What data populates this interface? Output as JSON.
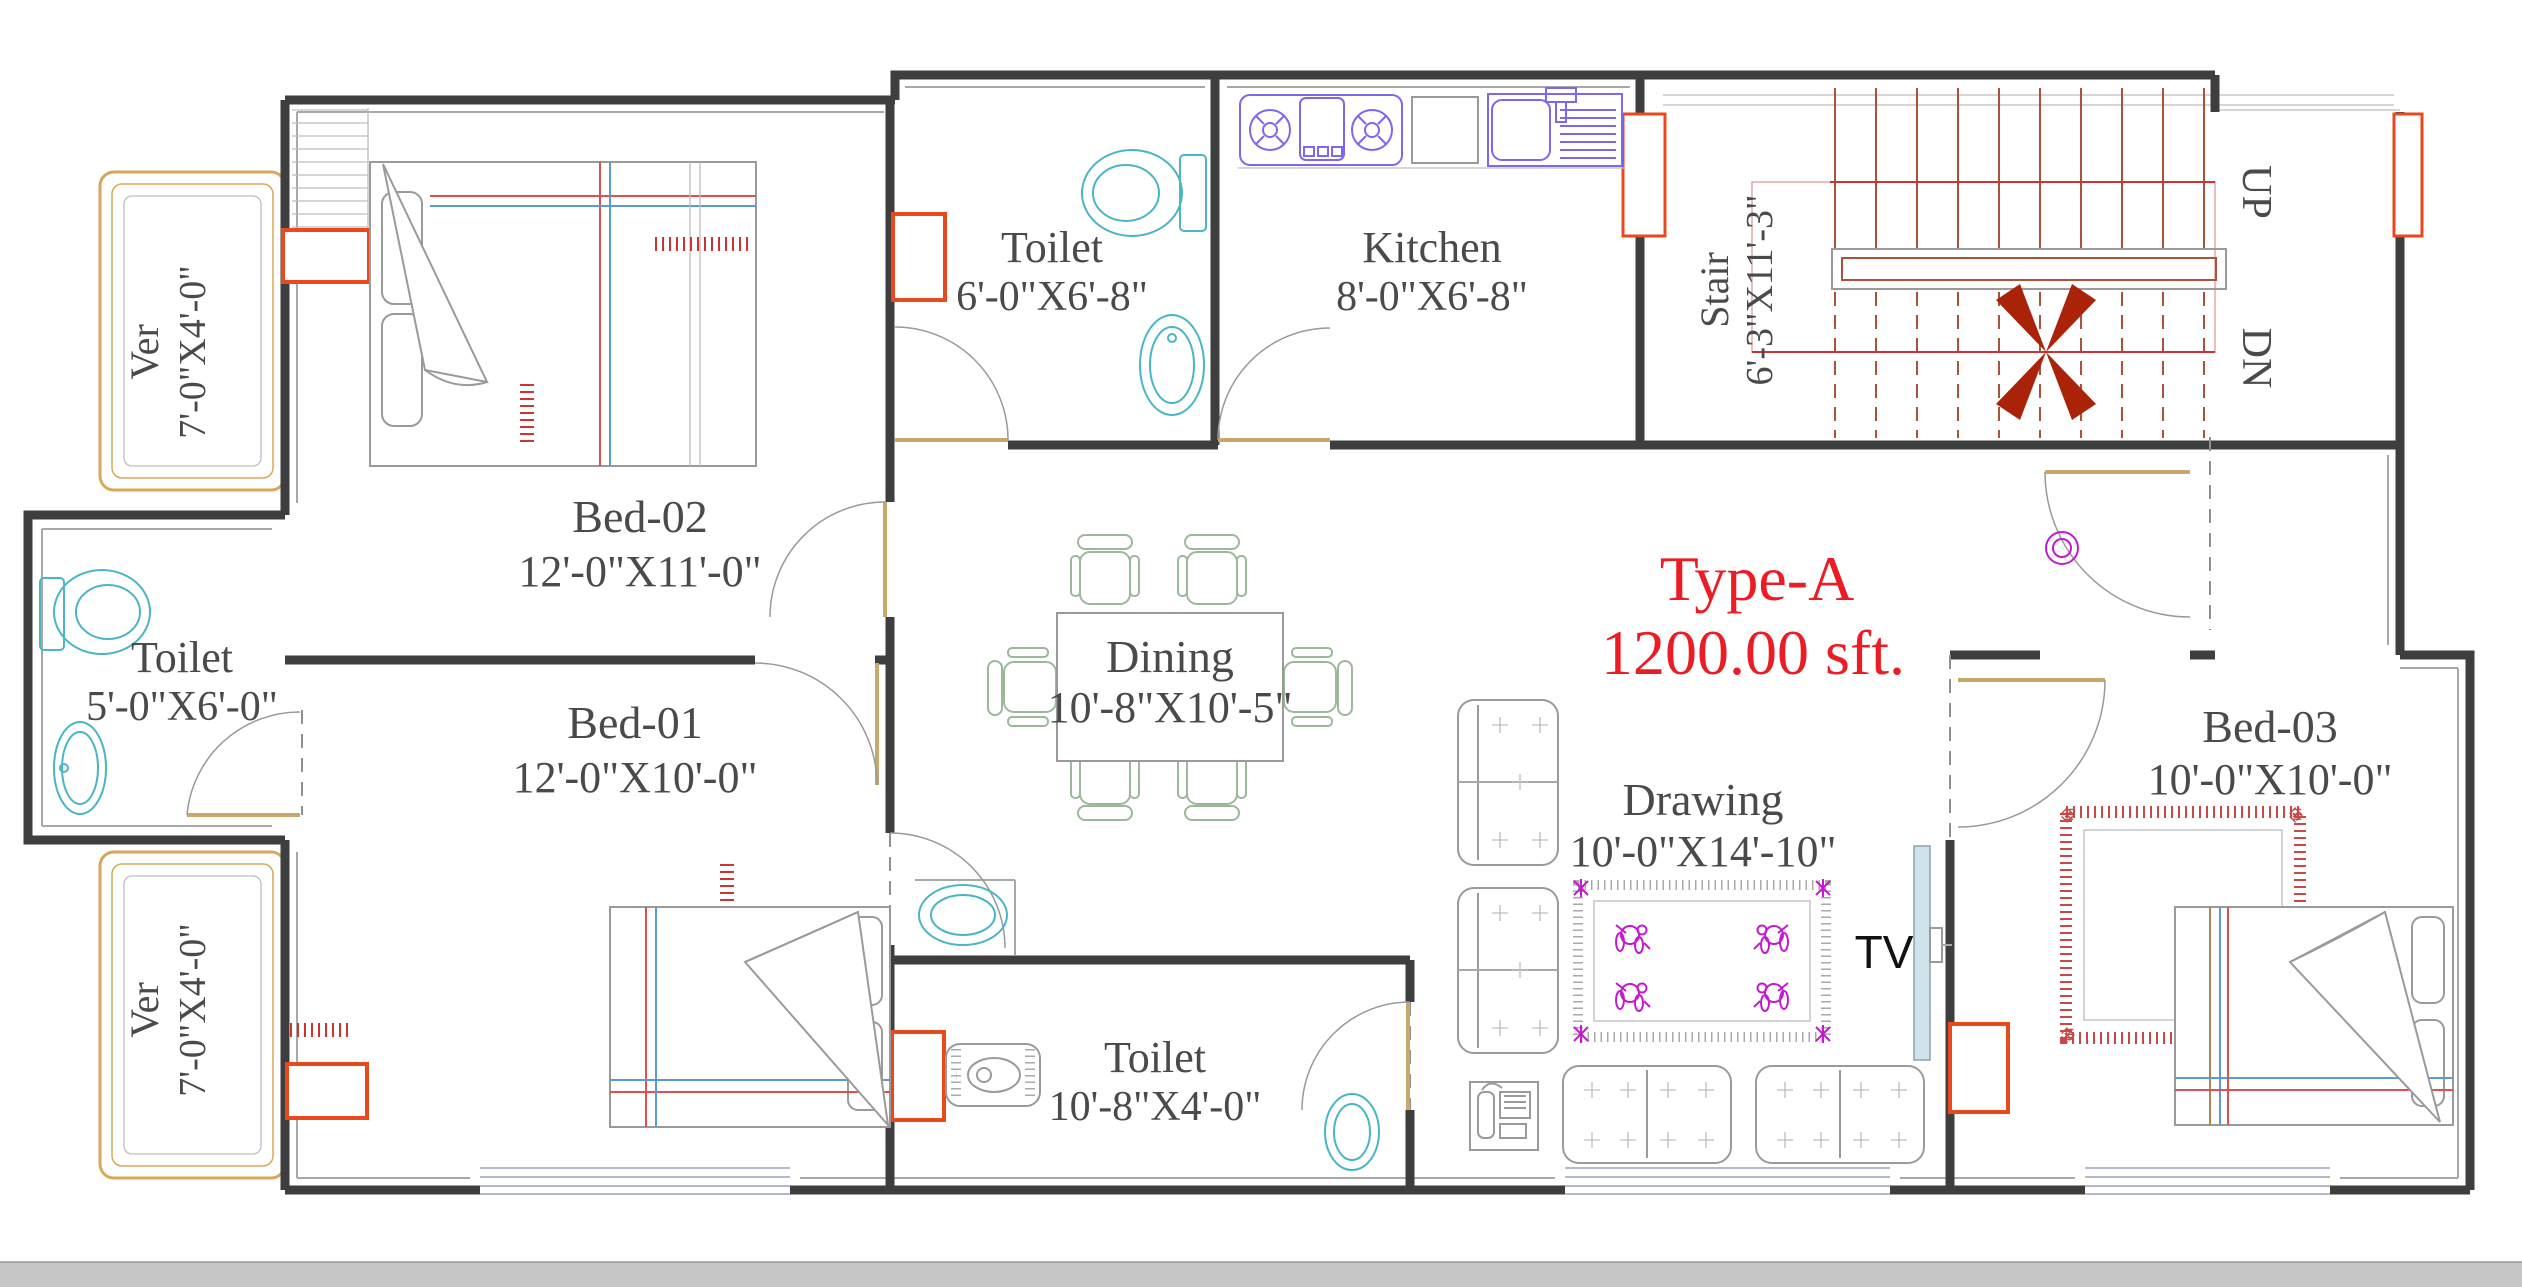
{
  "title": {
    "line1": "Type-A",
    "line2": "1200.00 sft."
  },
  "rooms": {
    "ver_top": {
      "name": "Ver",
      "dims": "7'-0\"X4'-0\""
    },
    "bed02": {
      "name": "Bed-02",
      "dims": "12'-0\"X11'-0\""
    },
    "toilet_top": {
      "name": "Toilet",
      "dims": "6'-0\"X6'-8\""
    },
    "kitchen": {
      "name": "Kitchen",
      "dims": "8'-0\"X6'-8\""
    },
    "stair": {
      "name": "Stair",
      "dims": "6'-3\"X11'-3\""
    },
    "toilet_left": {
      "name": "Toilet",
      "dims": "5'-0\"X6'-0\""
    },
    "bed01": {
      "name": "Bed-01",
      "dims": "12'-0\"X10'-0\""
    },
    "dining": {
      "name": "Dining",
      "dims": "10'-8\"X10'-5\""
    },
    "drawing": {
      "name": "Drawing",
      "dims": "10'-0\"X14'-10\""
    },
    "bed03": {
      "name": "Bed-03",
      "dims": "10'-0\"X10'-0\""
    },
    "toilet_bottom": {
      "name": "Toilet",
      "dims": "10'-8\"X4'-0\""
    },
    "ver_bottom": {
      "name": "Ver",
      "dims": "7'-0\"X4'-0\""
    }
  },
  "annotations": {
    "up": "UP",
    "dn": "DN",
    "tv": "TV"
  },
  "colors": {
    "wall": "#3e3e3e",
    "column_accent": "#e8491d",
    "door_leaf": "#c8a96a",
    "veranda_border": "#d9a75a",
    "fixture_teal": "#4ab5c4",
    "kitchen_purple": "#7b68ee",
    "carpet_red": "#cc3333",
    "stair_tread": "#a8543a",
    "stair_rail": "#e8832a",
    "stair_cross": "#aa2208",
    "rug_magenta": "#c31ad0",
    "title_red": "#ec1c24",
    "label_gray": "#4a4a4a"
  }
}
